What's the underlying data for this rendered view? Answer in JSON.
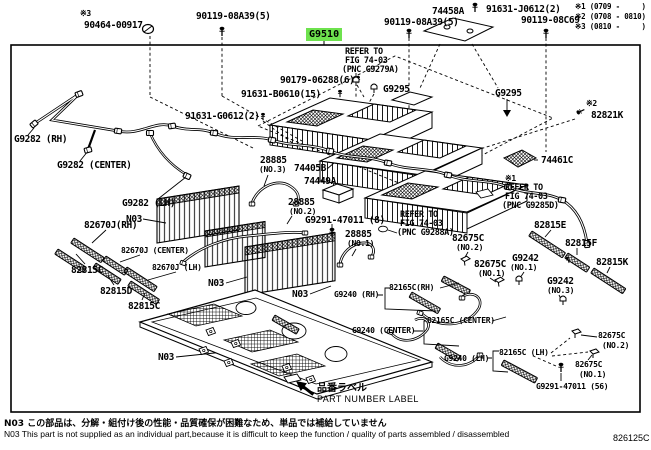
{
  "meta": {
    "doc_number": "826125C"
  },
  "highlight": {
    "part": "G9510",
    "color": "#6ee24e"
  },
  "legend": {
    "items": [
      "※1 (0709 -     )",
      "※2 (0708 - 0810)",
      "※3 (0810 -     )"
    ]
  },
  "notes": {
    "jp": "N03 この部品は、分解・組付け後の性能・品質確保が困難なため、単品では補給していません",
    "en": "N03 This part is not supplied as an individual part,because it is difficult to keep the function / quality of parts assembled / disassembled"
  },
  "part_number_label": {
    "jp": "品番ラベル",
    "en": "PART NUMBER LABEL"
  },
  "icons": {
    "bolt": "t-pin-fastener",
    "grommet": "ring-clip",
    "clamp": "u-clip",
    "arrow-down": "▼",
    "part-label-arrow": "solid-arrow-up-left"
  },
  "labels": [
    {
      "n": "ref3-mark-top",
      "t": "※3",
      "x": 80,
      "y": 9,
      "c": "sm",
      "i": false
    },
    {
      "n": "part-90464-00917",
      "t": "90464-00917",
      "x": 84,
      "y": 20,
      "c": "lbl"
    },
    {
      "n": "part-90119-08a39-left",
      "t": "90119-08A39(5)",
      "x": 196,
      "y": 11,
      "c": "lbl"
    },
    {
      "n": "part-74458a",
      "t": "74458A",
      "x": 432,
      "y": 6,
      "c": "lbl"
    },
    {
      "n": "part-91631-j0612",
      "t": "91631-J0612(2)",
      "x": 486,
      "y": 4,
      "c": "lbl"
    },
    {
      "n": "part-90119-08a39-mid",
      "t": "90119-08A39(5)",
      "x": 384,
      "y": 17,
      "c": "lbl"
    },
    {
      "n": "part-90119-08c69",
      "t": "90119-08C69",
      "x": 521,
      "y": 15,
      "c": "lbl"
    },
    {
      "n": "refer-g9279a-1",
      "t": "REFER TO",
      "x": 345,
      "y": 47,
      "c": "ref",
      "i": false
    },
    {
      "n": "refer-g9279a-2",
      "t": "FIG 74-03",
      "x": 345,
      "y": 56,
      "c": "ref",
      "i": false
    },
    {
      "n": "refer-g9279a-3",
      "t": "(PNC G9279A)",
      "x": 342,
      "y": 65,
      "c": "ref",
      "i": false
    },
    {
      "n": "part-90179-06288",
      "t": "90179-06288(6)",
      "x": 280,
      "y": 75,
      "c": "lbl"
    },
    {
      "n": "part-91631-b0610",
      "t": "91631-B0610(15)",
      "x": 241,
      "y": 89,
      "c": "lbl"
    },
    {
      "n": "part-91631-g0612",
      "t": "91631-G0612(2)",
      "x": 185,
      "y": 111,
      "c": "lbl"
    },
    {
      "n": "part-g9295-left",
      "t": "G9295",
      "x": 383,
      "y": 84,
      "c": "lbl"
    },
    {
      "n": "part-g9295-right",
      "t": "G9295",
      "x": 495,
      "y": 88,
      "c": "lbl"
    },
    {
      "n": "ref2-mark",
      "t": "※2",
      "x": 586,
      "y": 99,
      "c": "sm",
      "i": false
    },
    {
      "n": "part-82821k",
      "t": "82821K",
      "x": 591,
      "y": 110,
      "c": "lbl"
    },
    {
      "n": "part-74461c",
      "t": "74461C",
      "x": 541,
      "y": 155,
      "c": "lbl"
    },
    {
      "n": "ref1-mark",
      "t": "※1",
      "x": 505,
      "y": 174,
      "c": "sm",
      "i": false
    },
    {
      "n": "refer-g9285d-1",
      "t": "REFER TO",
      "x": 505,
      "y": 183,
      "c": "ref",
      "i": false
    },
    {
      "n": "refer-g9285d-2",
      "t": "FIG 74-03",
      "x": 505,
      "y": 192,
      "c": "ref",
      "i": false
    },
    {
      "n": "refer-g9285d-3",
      "t": "(PNC G9285D)",
      "x": 502,
      "y": 201,
      "c": "ref",
      "i": false
    },
    {
      "n": "part-28885-no3",
      "t": "28885",
      "x": 260,
      "y": 155,
      "c": "lbl"
    },
    {
      "n": "part-28885-no3-sub",
      "t": "(NO.3)",
      "x": 259,
      "y": 165,
      "c": "sm"
    },
    {
      "n": "part-74405b",
      "t": "74405B",
      "x": 294,
      "y": 163,
      "c": "lbl"
    },
    {
      "n": "part-74449a",
      "t": "74449A",
      "x": 304,
      "y": 176,
      "c": "lbl"
    },
    {
      "n": "part-28885-no2",
      "t": "28885",
      "x": 288,
      "y": 197,
      "c": "lbl"
    },
    {
      "n": "part-28885-no2-sub",
      "t": "(NO.2)",
      "x": 289,
      "y": 207,
      "c": "sm"
    },
    {
      "n": "part-g9291-47011-8",
      "t": "G9291-47011 (8)",
      "x": 305,
      "y": 215,
      "c": "lbl"
    },
    {
      "n": "part-28885-no1",
      "t": "28885",
      "x": 345,
      "y": 229,
      "c": "lbl"
    },
    {
      "n": "part-28885-no1-sub",
      "t": "(NO.1)",
      "x": 347,
      "y": 239,
      "c": "sm"
    },
    {
      "n": "refer-g9288a-1",
      "t": "REFER TO",
      "x": 400,
      "y": 210,
      "c": "ref",
      "i": false
    },
    {
      "n": "refer-g9288a-2",
      "t": "FIG 74-03",
      "x": 400,
      "y": 219,
      "c": "ref",
      "i": false
    },
    {
      "n": "refer-g9288a-3",
      "t": "(PNC G9288A)",
      "x": 397,
      "y": 228,
      "c": "ref",
      "i": false
    },
    {
      "n": "part-82815e",
      "t": "82815E",
      "x": 534,
      "y": 220,
      "c": "lbl"
    },
    {
      "n": "part-82815f",
      "t": "82815F",
      "x": 565,
      "y": 238,
      "c": "lbl"
    },
    {
      "n": "part-82815k",
      "t": "82815K",
      "x": 596,
      "y": 257,
      "c": "lbl"
    },
    {
      "n": "part-82675c-no2-upper",
      "t": "82675C",
      "x": 452,
      "y": 233,
      "c": "lbl"
    },
    {
      "n": "part-82675c-no2-upper-sub",
      "t": "(NO.2)",
      "x": 456,
      "y": 243,
      "c": "sm"
    },
    {
      "n": "part-82675c-no1-upper",
      "t": "82675C",
      "x": 474,
      "y": 259,
      "c": "lbl"
    },
    {
      "n": "part-82675c-no1-upper-sub",
      "t": "(NO.1)",
      "x": 478,
      "y": 269,
      "c": "sm"
    },
    {
      "n": "part-g9242-no1",
      "t": "G9242",
      "x": 512,
      "y": 253,
      "c": "lbl"
    },
    {
      "n": "part-g9242-no1-sub",
      "t": "(NO.1)",
      "x": 510,
      "y": 263,
      "c": "sm"
    },
    {
      "n": "part-g9242-no3",
      "t": "G9242",
      "x": 547,
      "y": 276,
      "c": "lbl"
    },
    {
      "n": "part-g9242-no3-sub",
      "t": "(NO.3)",
      "x": 547,
      "y": 286,
      "c": "sm"
    },
    {
      "n": "part-g9282-rh",
      "t": "G9282 (RH)",
      "x": 14,
      "y": 134,
      "c": "lbl"
    },
    {
      "n": "part-g9282-center",
      "t": "G9282 (CENTER)",
      "x": 57,
      "y": 160,
      "c": "lbl"
    },
    {
      "n": "part-g9282-lh",
      "t": "G9282 (LH)",
      "x": 122,
      "y": 198,
      "c": "lbl"
    },
    {
      "n": "part-82670j-rh",
      "t": "82670J(RH)",
      "x": 84,
      "y": 220,
      "c": "lbl"
    },
    {
      "n": "part-82670j-center",
      "t": "82670J (CENTER)",
      "x": 121,
      "y": 246,
      "c": "sm"
    },
    {
      "n": "part-82670j-lh",
      "t": "82670J (LH)",
      "x": 152,
      "y": 263,
      "c": "sm"
    },
    {
      "n": "part-82815c-1",
      "t": "82815C",
      "x": 71,
      "y": 265,
      "c": "lbl"
    },
    {
      "n": "part-82815d",
      "t": "82815D",
      "x": 100,
      "y": 286,
      "c": "lbl"
    },
    {
      "n": "part-82815c-2",
      "t": "82815C",
      "x": 128,
      "y": 301,
      "c": "lbl"
    },
    {
      "n": "note-n03-1",
      "t": "N03",
      "x": 126,
      "y": 214,
      "c": "lbl",
      "i": false
    },
    {
      "n": "note-n03-2",
      "t": "N03",
      "x": 208,
      "y": 278,
      "c": "lbl",
      "i": false
    },
    {
      "n": "note-n03-3",
      "t": "N03",
      "x": 292,
      "y": 289,
      "c": "lbl",
      "i": false
    },
    {
      "n": "note-n03-4",
      "t": "N03",
      "x": 158,
      "y": 352,
      "c": "lbl",
      "i": false
    },
    {
      "n": "part-g9240-rh",
      "t": "G9240 (RH)",
      "x": 334,
      "y": 290,
      "c": "sm"
    },
    {
      "n": "part-82165c-rh",
      "t": "82165C(RH)",
      "x": 389,
      "y": 283,
      "c": "sm"
    },
    {
      "n": "part-82165c-center",
      "t": "82165C (CENTER)",
      "x": 427,
      "y": 316,
      "c": "sm"
    },
    {
      "n": "part-g9240-center",
      "t": "G9240 (CENTER)",
      "x": 352,
      "y": 326,
      "c": "sm"
    },
    {
      "n": "part-g9240-lh",
      "t": "G9240 (LH)",
      "x": 444,
      "y": 354,
      "c": "sm"
    },
    {
      "n": "part-82165c-lh",
      "t": "82165C (LH)",
      "x": 499,
      "y": 348,
      "c": "sm"
    },
    {
      "n": "part-82675c-no2-lower",
      "t": "82675C",
      "x": 598,
      "y": 331,
      "c": "sm"
    },
    {
      "n": "part-82675c-no2-lower-sub",
      "t": "(NO.2)",
      "x": 602,
      "y": 341,
      "c": "sm"
    },
    {
      "n": "part-82675c-no1-lower",
      "t": "82675C",
      "x": 575,
      "y": 360,
      "c": "sm"
    },
    {
      "n": "part-82675c-no1-lower-sub",
      "t": "(NO.1)",
      "x": 579,
      "y": 370,
      "c": "sm"
    },
    {
      "n": "part-g9291-47011-56",
      "t": "G9291-47011 (56)",
      "x": 536,
      "y": 382,
      "c": "sm"
    }
  ]
}
